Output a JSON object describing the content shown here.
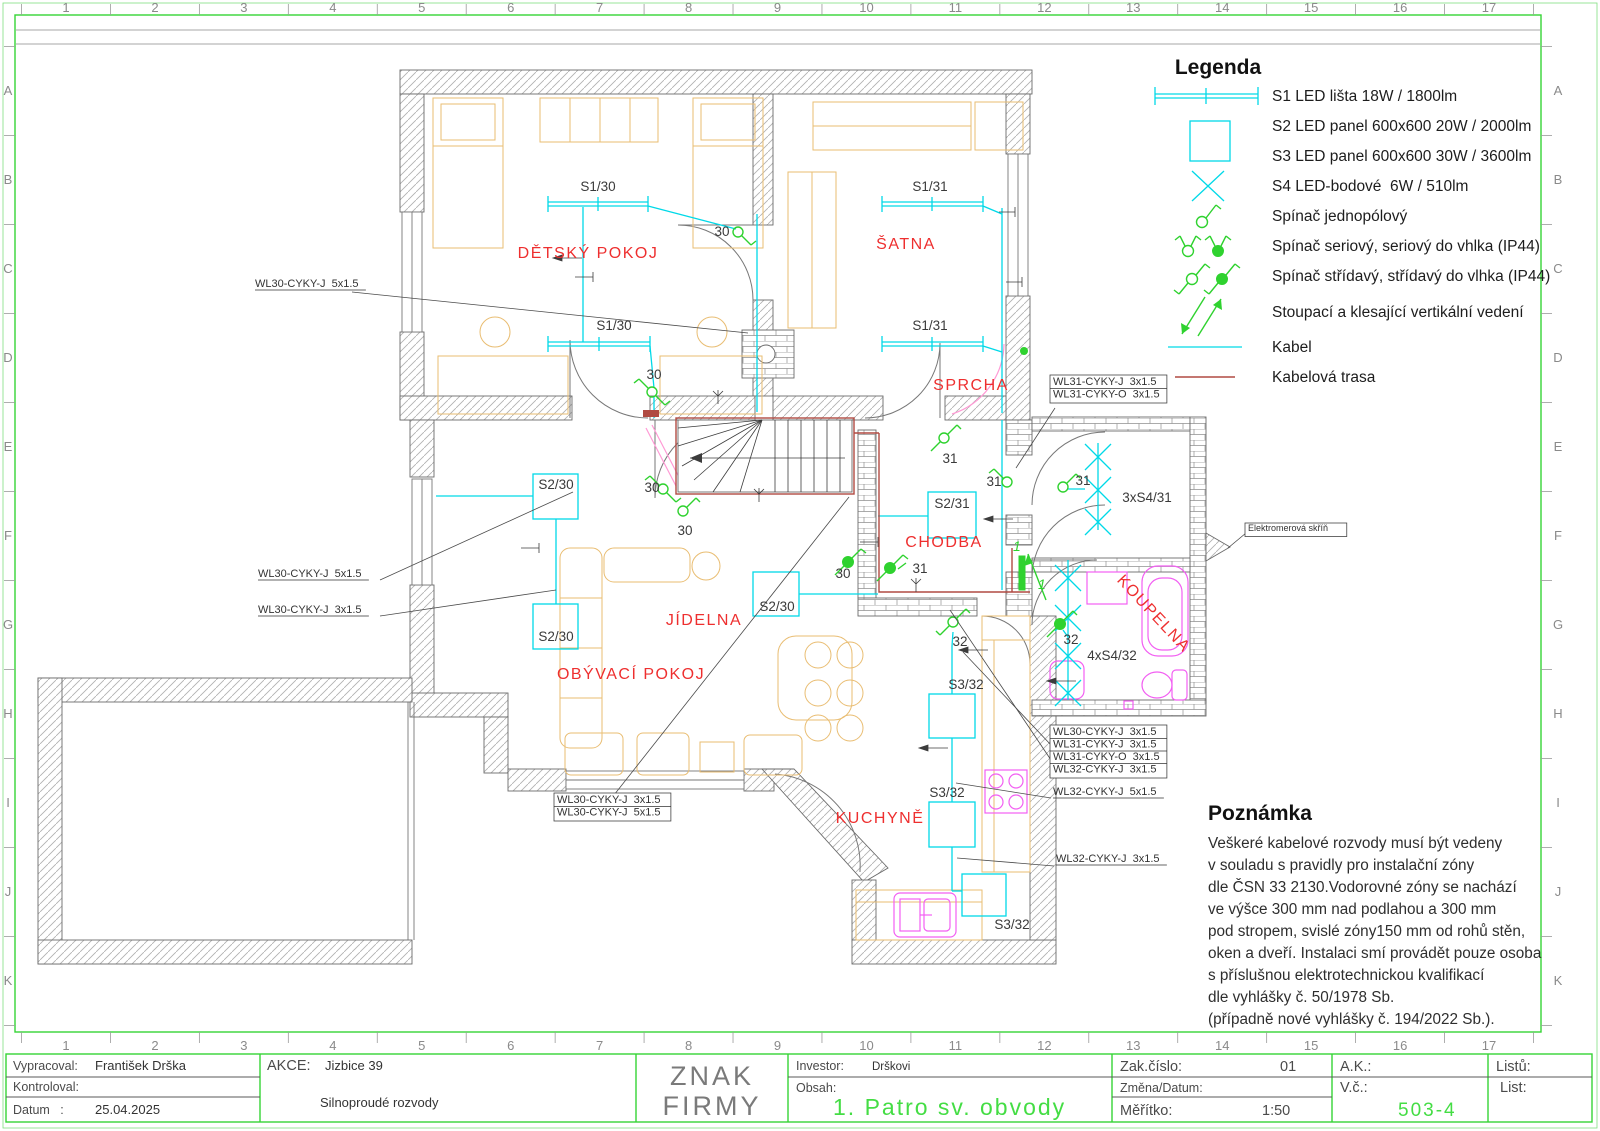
{
  "grid": {
    "columns": [
      "1",
      "2",
      "3",
      "4",
      "5",
      "6",
      "7",
      "8",
      "9",
      "10",
      "11",
      "12",
      "13",
      "14",
      "15",
      "16",
      "17"
    ],
    "rows": [
      "A",
      "B",
      "C",
      "D",
      "E",
      "F",
      "G",
      "H",
      "I",
      "J",
      "K"
    ]
  },
  "legend": {
    "title": "Legenda",
    "items": [
      {
        "symbol": "led-strip",
        "label": "S1 LED lišta 18W / 1800lm"
      },
      {
        "symbol": "led-panel-600",
        "label": "S2 LED panel 600x600 20W / 2000lm"
      },
      {
        "symbol": "led-panel-600",
        "label": "S3 LED panel 600x600 30W / 3600lm"
      },
      {
        "symbol": "led-spot",
        "label": "S4 LED-bodové  6W / 510lm"
      },
      {
        "symbol": "switch-single-pole",
        "label": "Spínač jednopólový"
      },
      {
        "symbol": "switch-series",
        "label": "Spínač seriový, seriový do vhlka (IP44)"
      },
      {
        "symbol": "switch-two-way",
        "label": "Spínač střídavý, střídavý do vlhka (IP44)"
      },
      {
        "symbol": "vertical-riser",
        "label": "Stoupací a klesající vertikální vedení"
      },
      {
        "symbol": "cable",
        "label": "Kabel"
      },
      {
        "symbol": "cable-route",
        "label": "Kabelová trasa"
      }
    ]
  },
  "note": {
    "title": "Poznámka",
    "lines": [
      "Veškeré kabelové rozvody musí být vedeny",
      "v souladu s pravidly pro instalační zóny",
      "dle ČSN 33 2130.Vodorovné zóny se nachází",
      "ve výšce 300 mm nad podlahou a 300 mm",
      "pod stropem, svislé zóny150 mm od rohů stěn,",
      "oken a dveří. Instalaci smí provádět pouze osoba",
      "s příslušnou elektrotechnickou kvalifikací",
      "dle vyhlášky č. 50/1978 Sb.",
      "(případně nové vyhlášky č. 194/2022 Sb.)."
    ]
  },
  "plan": {
    "rooms": [
      {
        "name": "DĚTSKÝ POKOJ",
        "x": 588,
        "y": 258
      },
      {
        "name": "ŠATNA",
        "x": 906,
        "y": 249
      },
      {
        "name": "SPRCHA",
        "x": 971,
        "y": 390
      },
      {
        "name": "CHODBA",
        "x": 944,
        "y": 547
      },
      {
        "name": "JÍDELNA",
        "x": 704,
        "y": 625
      },
      {
        "name": "OBÝVACÍ POKOJ",
        "x": 631,
        "y": 679
      },
      {
        "name": "KUCHYNĚ",
        "x": 880,
        "y": 823
      },
      {
        "name": "KOUPELNA",
        "x": 1150,
        "y": 617,
        "rot": 47
      }
    ],
    "circuit_labels": [
      {
        "t": "S1/30",
        "x": 598,
        "y": 191
      },
      {
        "t": "S1/30",
        "x": 614,
        "y": 330
      },
      {
        "t": "S1/31",
        "x": 930,
        "y": 191
      },
      {
        "t": "S1/31",
        "x": 930,
        "y": 330
      },
      {
        "t": "S2/30",
        "x": 556,
        "y": 489
      },
      {
        "t": "S2/30",
        "x": 556,
        "y": 641
      },
      {
        "t": "S2/30",
        "x": 777,
        "y": 611
      },
      {
        "t": "S2/31",
        "x": 952,
        "y": 508
      },
      {
        "t": "3xS4/31",
        "x": 1147,
        "y": 502
      },
      {
        "t": "4xS4/32",
        "x": 1112,
        "y": 660
      },
      {
        "t": "S3/32",
        "x": 966,
        "y": 689
      },
      {
        "t": "S3/32",
        "x": 947,
        "y": 797
      },
      {
        "t": "S3/32",
        "x": 1012,
        "y": 929
      }
    ],
    "switch_labels": [
      {
        "t": "30",
        "x": 722,
        "y": 236
      },
      {
        "t": "30",
        "x": 654,
        "y": 379
      },
      {
        "t": "30",
        "x": 652,
        "y": 492
      },
      {
        "t": "30",
        "x": 685,
        "y": 535
      },
      {
        "t": "30",
        "x": 843,
        "y": 578
      },
      {
        "t": "31",
        "x": 950,
        "y": 463
      },
      {
        "t": "31",
        "x": 994,
        "y": 486
      },
      {
        "t": "31",
        "x": 920,
        "y": 573
      },
      {
        "t": "31",
        "x": 1083,
        "y": 485
      },
      {
        "t": "32",
        "x": 960,
        "y": 646
      },
      {
        "t": "32",
        "x": 1071,
        "y": 644
      }
    ],
    "riser_labels": [
      {
        "t": "1",
        "x": 1013,
        "y": 551
      },
      {
        "t": "1",
        "x": 1038,
        "y": 589
      }
    ],
    "cable_labels": [
      {
        "lines": [
          "WL30-CYKY-J  5x1.5"
        ],
        "x": 255,
        "y": 287,
        "style": "underline"
      },
      {
        "lines": [
          "WL30-CYKY-J  5x1.5"
        ],
        "x": 258,
        "y": 577,
        "style": "underline"
      },
      {
        "lines": [
          "WL30-CYKY-J  3x1.5"
        ],
        "x": 258,
        "y": 613,
        "style": "underline"
      },
      {
        "lines": [
          "WL30-CYKY-J  3x1.5",
          "WL30-CYKY-J  5x1.5"
        ],
        "x": 557,
        "y": 803,
        "style": "boxed"
      },
      {
        "lines": [
          "WL31-CYKY-J  3x1.5",
          "WL31-CYKY-O  3x1.5"
        ],
        "x": 1053,
        "y": 385,
        "style": "boxed"
      },
      {
        "lines": [
          "WL30-CYKY-J  3x1.5",
          "WL31-CYKY-J  3x1.5",
          "WL31-CYKY-O  3x1.5",
          "WL32-CYKY-J  3x1.5"
        ],
        "x": 1053,
        "y": 735,
        "style": "boxed"
      },
      {
        "lines": [
          "WL32-CYKY-J  5x1.5"
        ],
        "x": 1053,
        "y": 795,
        "style": "underline"
      },
      {
        "lines": [
          "WL32-CYKY-J  3x1.5"
        ],
        "x": 1056,
        "y": 862,
        "style": "underline"
      },
      {
        "lines": [
          "Elektromerová skříň"
        ],
        "x": 1248,
        "y": 531,
        "style": "boxed",
        "size": 9
      }
    ]
  },
  "titleblock": {
    "vypracoval_label": "Vypracoval:",
    "vypracoval_value": "František Drška",
    "kontroloval_label": "Kontroloval:",
    "datum_label": "Datum   :",
    "datum_value": "25.04.2025",
    "akce_label": "AKCE:",
    "akce_value": "Jizbice 39",
    "subtitle": "Silnoproudé rozvody",
    "company_line1": "ZNAK",
    "company_line2": "FIRMY",
    "investor_label": "Investor:",
    "investor_value": "Drškovi",
    "obsah_label": "Obsah:",
    "obsah_value": "1. Patro sv. obvody",
    "zak_label": "Zak.číslo:",
    "zak_value": "01",
    "zmena_label": "Změna/Datum:",
    "meritko_label": "Měřítko:",
    "meritko_value": "1:50",
    "ak_label": "A.K.:",
    "vc_label": "V.č.:",
    "vc_value": "503-4",
    "listu_label": "Listů:",
    "list_label": "List:"
  }
}
